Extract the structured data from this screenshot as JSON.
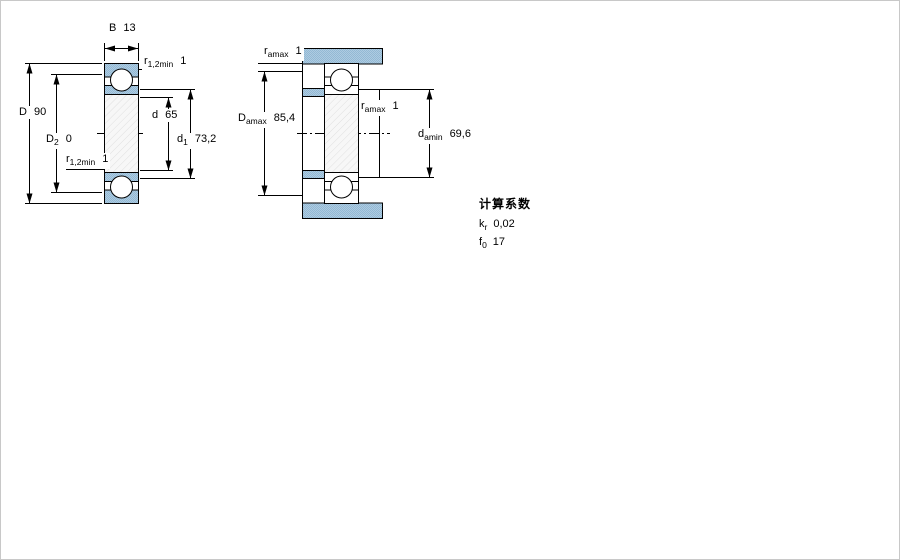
{
  "figure_left": {
    "dim_B": {
      "symbol": "B",
      "value": "13"
    },
    "dim_r_top": {
      "symbol": "r",
      "sub": "1,2min",
      "value": "1"
    },
    "dim_D": {
      "symbol": "D",
      "value": "90"
    },
    "dim_D2": {
      "symbol": "D",
      "sub": "2",
      "value": "0"
    },
    "dim_d": {
      "symbol": "d",
      "value": "65"
    },
    "dim_d1": {
      "symbol": "d",
      "sub": "1",
      "value": "73,2"
    },
    "dim_r_bottom": {
      "symbol": "r",
      "sub": "1,2min",
      "value": "1"
    }
  },
  "figure_right": {
    "dim_ra_top": {
      "symbol": "r",
      "sub": "amax",
      "value": "1"
    },
    "dim_Da": {
      "symbol": "D",
      "sub": "amax",
      "value": "85,4"
    },
    "dim_ra_mid": {
      "symbol": "r",
      "sub": "amax",
      "value": "1"
    },
    "dim_da": {
      "symbol": "d",
      "sub": "amin",
      "value": "69,6"
    }
  },
  "calculation_factors": {
    "title": "计算系数",
    "rows": [
      {
        "symbol": "k",
        "sub": "r",
        "value": "0,02"
      },
      {
        "symbol": "f",
        "sub": "0",
        "value": "17"
      }
    ]
  },
  "colors": {
    "section_blue": "#aecbe1",
    "section_blue_dark": "#93b9d4",
    "hatch_line": "#e0e0e0",
    "line": "#000000"
  }
}
